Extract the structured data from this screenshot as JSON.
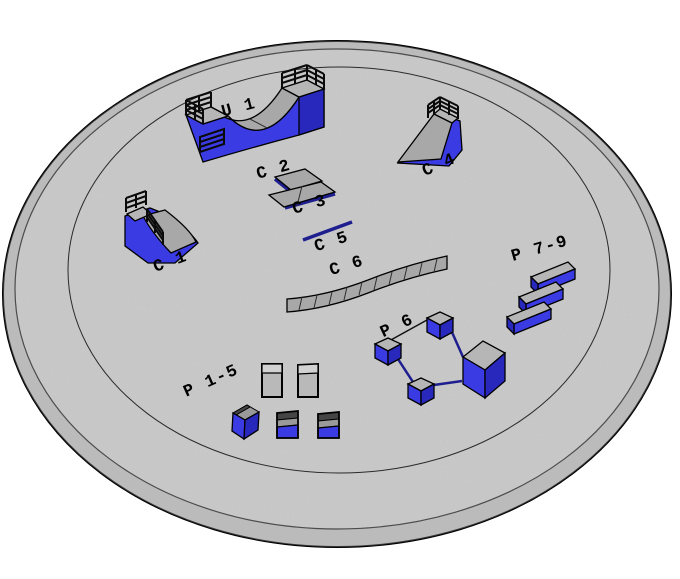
{
  "scene": {
    "kind": "3d-isometric-skatepark-layout-diagram"
  },
  "colors": {
    "background": "#ffffff",
    "platform_top": "#d6d6d6",
    "platform_side": "#c3c3c3",
    "ramp_gray": "#a8a8a8",
    "deck_gray": "#b6b6b6",
    "panel_gray": "#b9b9b9",
    "panel_top_gray": "#d2d2d2",
    "box_dark_top": "#454545",
    "box_mid_gray": "#9a9a9a",
    "blue": "#3b3be4",
    "blue_dark": "#2828bd",
    "navy": "#1e1e8f",
    "outline": "#000000"
  },
  "items": [
    {
      "id": "u1",
      "label": "U 1"
    },
    {
      "id": "c1",
      "label": "C 1"
    },
    {
      "id": "c2",
      "label": "C 2"
    },
    {
      "id": "c3",
      "label": "C 3"
    },
    {
      "id": "c4",
      "label": "C 4"
    },
    {
      "id": "c5",
      "label": "C 5"
    },
    {
      "id": "c6",
      "label": "C 6"
    },
    {
      "id": "p1_5",
      "label": "P 1-5"
    },
    {
      "id": "p6",
      "label": "P 6"
    },
    {
      "id": "p7_9",
      "label": "P 7-9"
    }
  ]
}
